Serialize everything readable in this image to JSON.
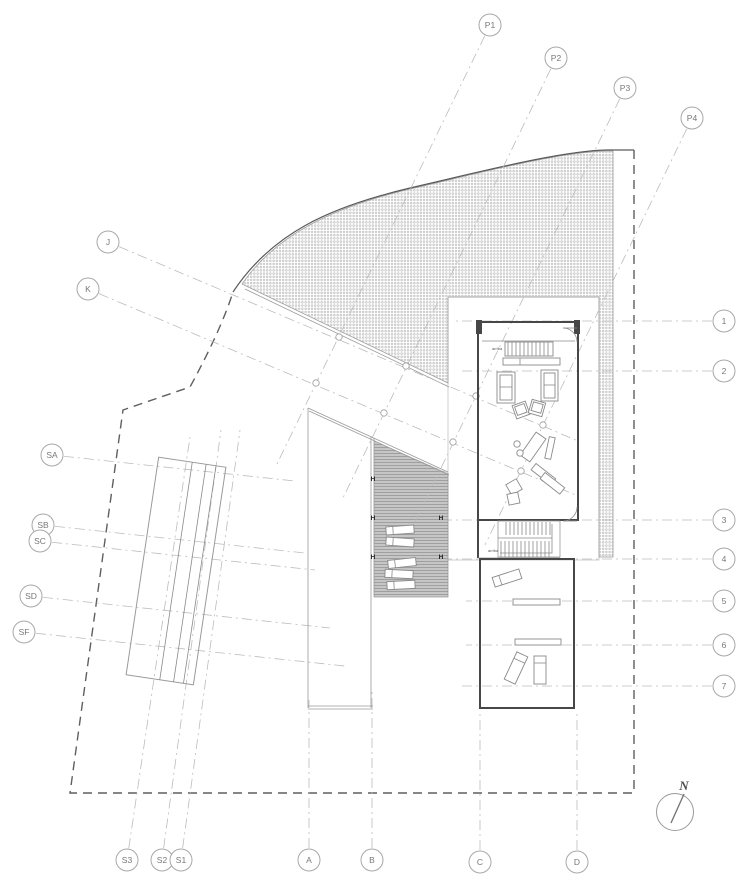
{
  "grid_bubbles": {
    "top": [
      "P1",
      "P2",
      "P3",
      "P4"
    ],
    "left": [
      "J",
      "K",
      "SA",
      "SB",
      "SC",
      "SD",
      "SF"
    ],
    "right": [
      "1",
      "2",
      "3",
      "4",
      "5",
      "6",
      "7"
    ],
    "bottom": [
      "S3",
      "S2",
      "S1",
      "A",
      "B",
      "C",
      "D"
    ]
  },
  "labels": {
    "stair_upper": "arriba",
    "stair_lower": "arriba",
    "column_marker": "H",
    "north": "N"
  },
  "colors": {
    "boundary": "#5f5f5f",
    "grid_line": "#bcbcbc",
    "wall": "#474747",
    "hatch_dot": "#a9a9a9",
    "deck_fill": "#c6c6c6",
    "deck_stripe": "#8f8f8f",
    "bubble_stroke": "#a8a8a8",
    "bubble_text": "#787878"
  }
}
